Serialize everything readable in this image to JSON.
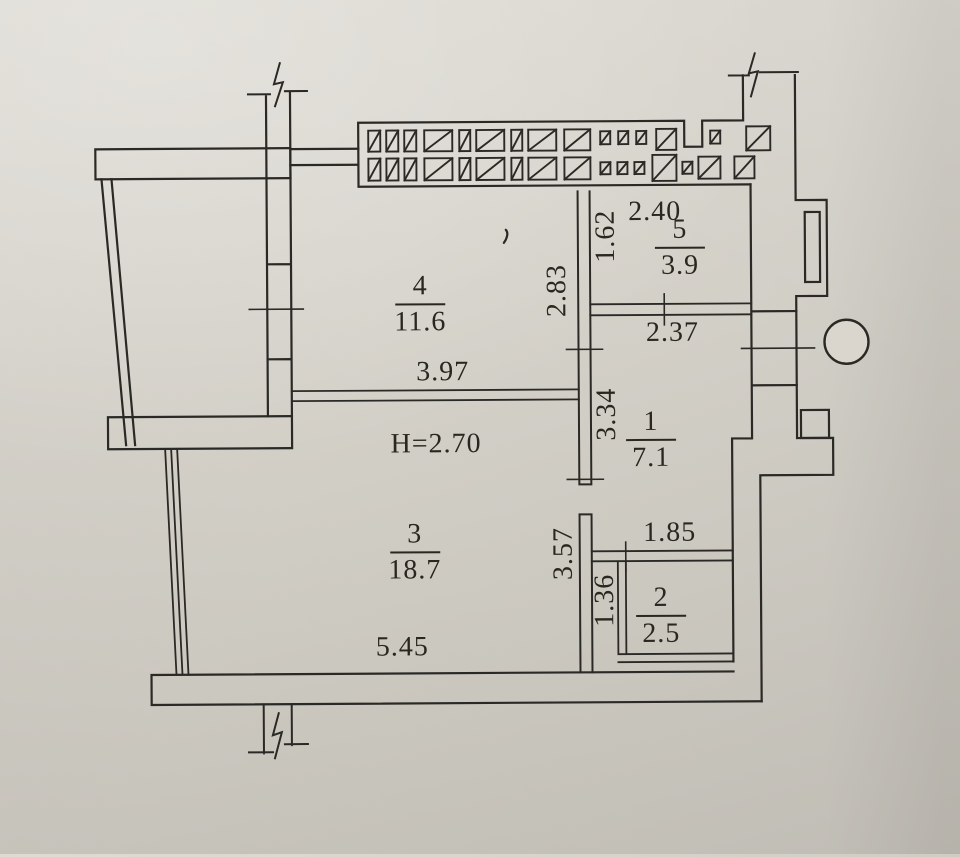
{
  "plan": {
    "title": "apartment floor plan",
    "ceiling_height_label": "Н=2.70"
  },
  "rooms": [
    {
      "number": "1",
      "area": "7.1"
    },
    {
      "number": "2",
      "area": "2.5"
    },
    {
      "number": "3",
      "area": "18.7"
    },
    {
      "number": "4",
      "area": "11.6"
    },
    {
      "number": "5",
      "area": "3.9"
    }
  ],
  "dimensions": {
    "room5_width": "2.40",
    "room5_height": "1.62",
    "room4_height": "2.83",
    "room1_width": "2.37",
    "room4_width": "3.97",
    "room1_height": "3.34",
    "hallway_width": "1.85",
    "room3_height": "3.57",
    "room2_height": "1.36",
    "room3_width": "5.45"
  },
  "colors": {
    "paper": "#d6d2ca",
    "ink": "#2b2925"
  }
}
